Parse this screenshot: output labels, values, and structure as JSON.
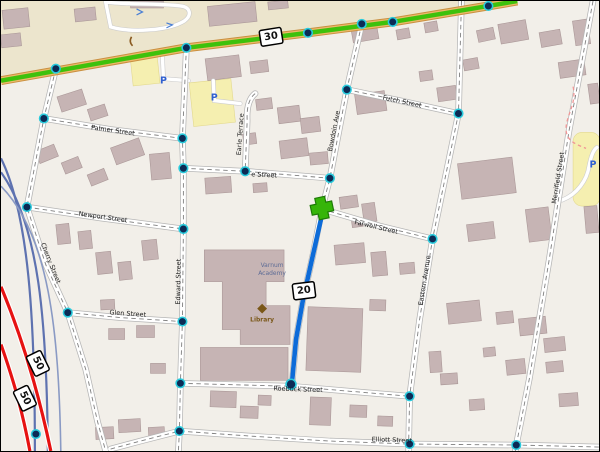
{
  "map": {
    "route_shields": {
      "route30": "30",
      "route20": "20",
      "route50_upper": "50",
      "route50_lower": "50"
    },
    "streets": {
      "palmer": "Palmer Street",
      "e_street": "e Street",
      "earle_terrace": "Earle Terrace",
      "newport": "Newport Street",
      "futch": "Futch Street",
      "bowdoin": "Bowdoin Ave",
      "edward": "Edward Street",
      "cherry": "Cherry Street",
      "glen": "Glen Street",
      "farwell": "Farwell Street",
      "eastern": "Eastern Avenue",
      "merrifield": "Merrifield Street",
      "roebuck": "Roebuck Street",
      "elliott": "Elliott Street"
    },
    "pois": {
      "academy_line1": "Varnum",
      "academy_line2": "Academy",
      "library": "Library",
      "parking_symbol": "P"
    },
    "colors": {
      "background": "#f2efe9",
      "commercial_area": "#ece5cd",
      "parking_area": "#f5efb0",
      "building": "#c6b4b4",
      "route_highlight_green": "#3ec10c",
      "route_road_tan": "#eeb96a",
      "route_line_blue": "#0d6bd8",
      "trunk_red": "#e61212",
      "railway_blue": "#5e72b0",
      "node_fill": "#0c2b55",
      "node_ring": "#29cbdd",
      "start_marker_green": "#36b509"
    }
  }
}
